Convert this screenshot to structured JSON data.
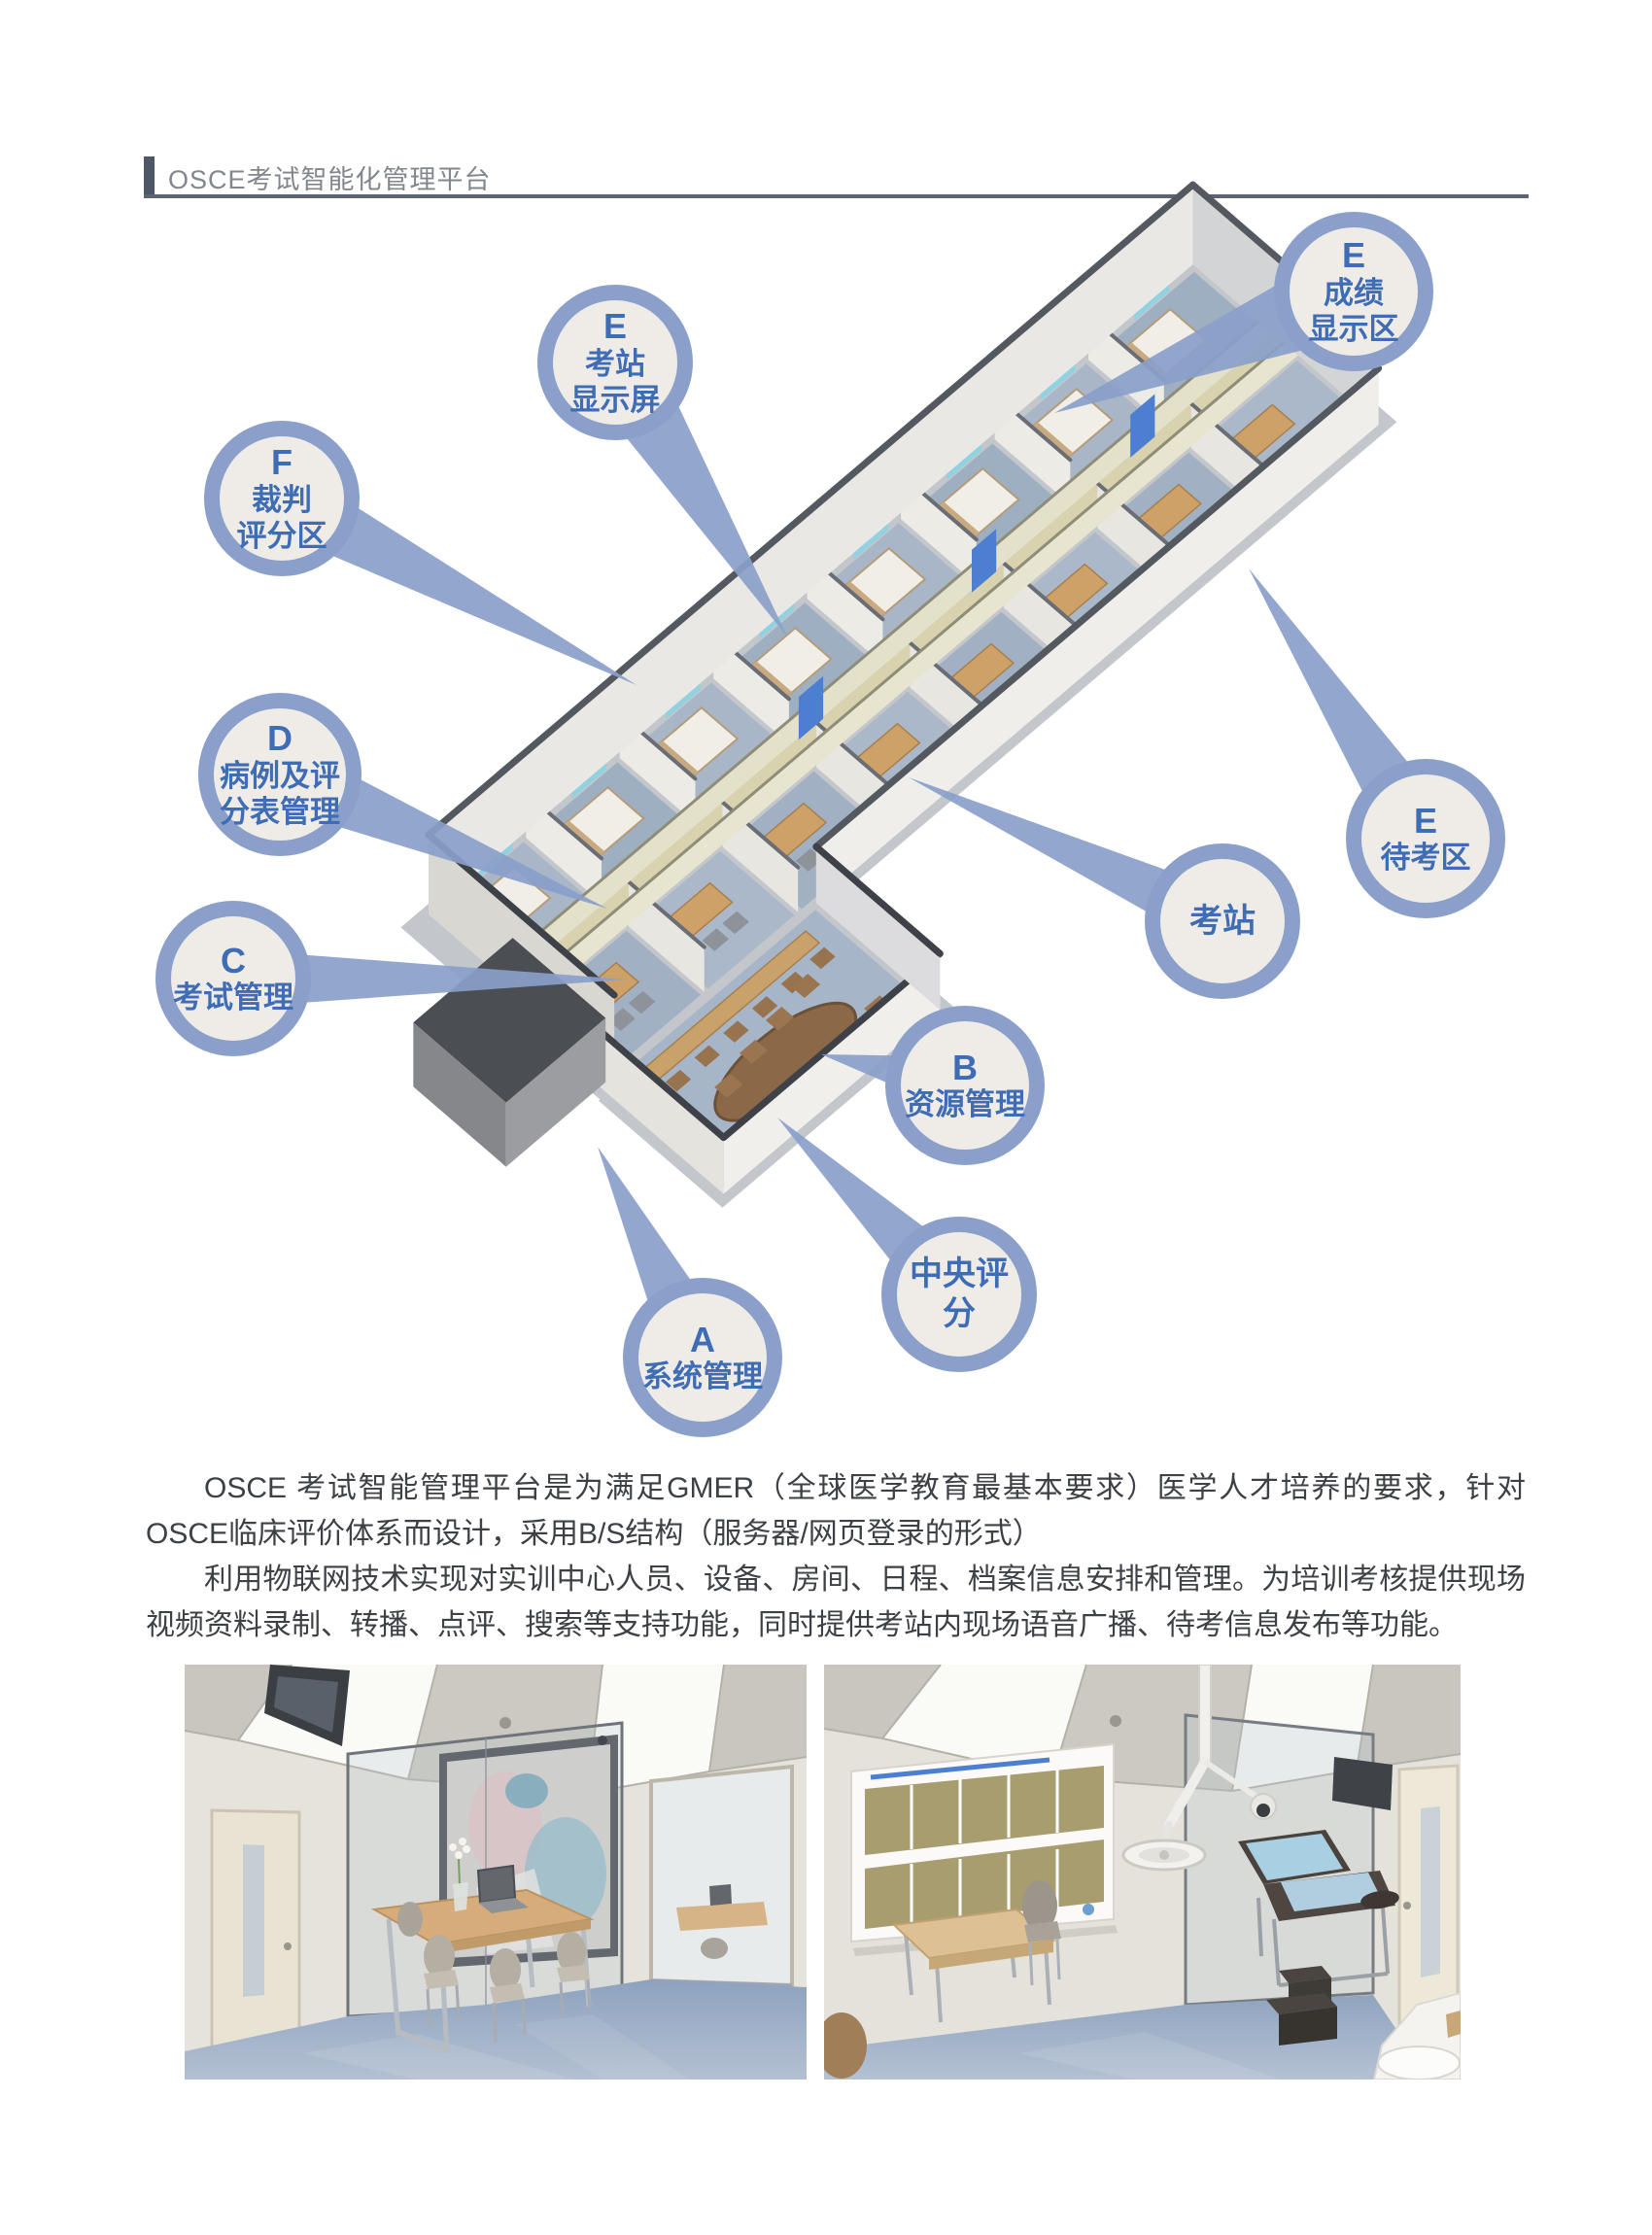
{
  "header": {
    "title": "OSCE考试智能化管理平台",
    "accent_color": "#4e5765"
  },
  "diagram": {
    "colors": {
      "ring": "#8a9fca",
      "inner": "#efece7",
      "text": "#3f6db5"
    },
    "bubbles": [
      {
        "letter": "E",
        "label": "考站\n显示屏"
      },
      {
        "letter": "E",
        "label": "成绩\n显示区"
      },
      {
        "letter": "F",
        "label": "裁判\n评分区"
      },
      {
        "letter": "D",
        "label": "病例及评\n分表管理"
      },
      {
        "letter": "C",
        "label": "考试管理"
      },
      {
        "letter": "E",
        "label": "待考区"
      },
      {
        "letter": "",
        "label": "考站"
      },
      {
        "letter": "B",
        "label": "资源管理"
      },
      {
        "letter": "",
        "label": "中央评分"
      },
      {
        "letter": "A",
        "label": "系统管理"
      }
    ]
  },
  "body": {
    "p1": "OSCE 考试智能管理平台是为满足GMER（全球医学教育最基本要求）医学人才培养的要求，针对OSCE临床评价体系而设计，采用B/S结构（服务器/网页登录的形式）",
    "p2": "利用物联网技术实现对实训中心人员、设备、房间、日程、档案信息安排和管理。为培训考核提供现场视频资料录制、转播、点评、搜索等支持功能，同时提供考站内现场语音广播、待考信息发布等功能。"
  }
}
